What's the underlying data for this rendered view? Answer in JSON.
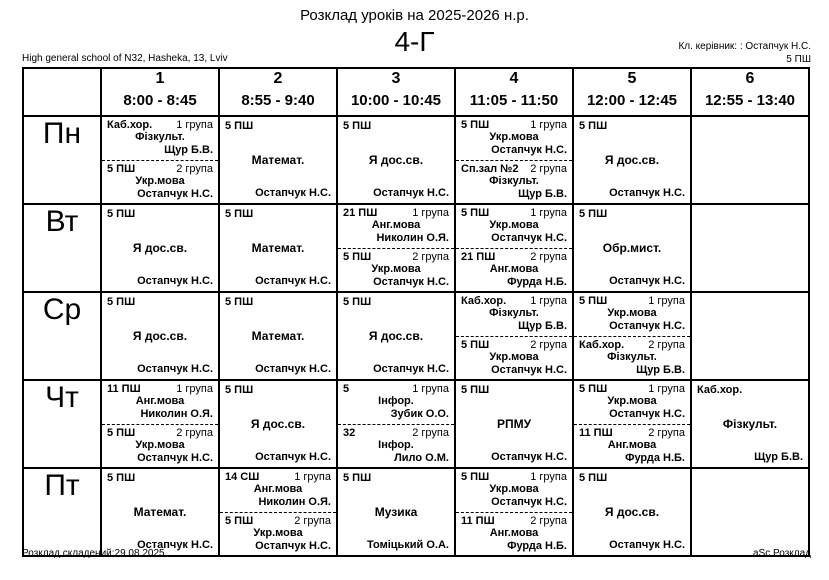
{
  "header": {
    "title": "Розклад уроків на 2025-2026 н.р.",
    "class_name": "4-Г",
    "school": "High general school of N32, Hasheka, 13, Lviv",
    "class_teacher_label": "Кл. керівник: : Остапчук Н.С.",
    "class_teacher_room": "5 ПШ"
  },
  "periods": [
    {
      "num": "1",
      "time": "8:00 - 8:45"
    },
    {
      "num": "2",
      "time": "8:55 - 9:40"
    },
    {
      "num": "3",
      "time": "10:00 - 10:45"
    },
    {
      "num": "4",
      "time": "11:05 - 11:50"
    },
    {
      "num": "5",
      "time": "12:00 - 12:45"
    },
    {
      "num": "6",
      "time": "12:55 - 13:40"
    }
  ],
  "timetable": [
    {
      "day": "Пн",
      "slots": [
        {
          "type": "split",
          "groups": [
            {
              "room": "Каб.хор.",
              "group": "1 група",
              "subject": "Фізкульт.",
              "teacher": "Щур Б.В."
            },
            {
              "room": "5 ПШ",
              "group": "2 група",
              "subject": "Укр.мова",
              "teacher": "Остапчук Н.С."
            }
          ]
        },
        {
          "type": "single",
          "room": "5 ПШ",
          "subject": "Математ.",
          "teacher": "Остапчук Н.С."
        },
        {
          "type": "single",
          "room": "5 ПШ",
          "subject": "Я дос.св.",
          "teacher": "Остапчук Н.С."
        },
        {
          "type": "split",
          "groups": [
            {
              "room": "5 ПШ",
              "group": "1 група",
              "subject": "Укр.мова",
              "teacher": "Остапчук Н.С."
            },
            {
              "room": "Сп.зал №2",
              "group": "2 група",
              "subject": "Фізкульт.",
              "teacher": "Щур Б.В."
            }
          ]
        },
        {
          "type": "single",
          "room": "5 ПШ",
          "subject": "Я дос.св.",
          "teacher": "Остапчук Н.С."
        },
        null
      ]
    },
    {
      "day": "Вт",
      "slots": [
        {
          "type": "single",
          "room": "5 ПШ",
          "subject": "Я дос.св.",
          "teacher": "Остапчук Н.С."
        },
        {
          "type": "single",
          "room": "5 ПШ",
          "subject": "Математ.",
          "teacher": "Остапчук Н.С."
        },
        {
          "type": "split",
          "groups": [
            {
              "room": "21 ПШ",
              "group": "1 група",
              "subject": "Анг.мова",
              "teacher": "Николин О.Я."
            },
            {
              "room": "5 ПШ",
              "group": "2 група",
              "subject": "Укр.мова",
              "teacher": "Остапчук Н.С."
            }
          ]
        },
        {
          "type": "split",
          "groups": [
            {
              "room": "5 ПШ",
              "group": "1 група",
              "subject": "Укр.мова",
              "teacher": "Остапчук Н.С."
            },
            {
              "room": "21 ПШ",
              "group": "2 група",
              "subject": "Анг.мова",
              "teacher": "Фурда Н.Б."
            }
          ]
        },
        {
          "type": "single",
          "room": "5 ПШ",
          "subject": "Обр.мист.",
          "teacher": "Остапчук Н.С."
        },
        null
      ]
    },
    {
      "day": "Ср",
      "slots": [
        {
          "type": "single",
          "room": "5 ПШ",
          "subject": "Я дос.св.",
          "teacher": "Остапчук Н.С."
        },
        {
          "type": "single",
          "room": "5 ПШ",
          "subject": "Математ.",
          "teacher": "Остапчук Н.С."
        },
        {
          "type": "single",
          "room": "5 ПШ",
          "subject": "Я дос.св.",
          "teacher": "Остапчук Н.С."
        },
        {
          "type": "split",
          "groups": [
            {
              "room": "Каб.хор.",
              "group": "1 група",
              "subject": "Фізкульт.",
              "teacher": "Щур Б.В."
            },
            {
              "room": "5 ПШ",
              "group": "2 група",
              "subject": "Укр.мова",
              "teacher": "Остапчук Н.С."
            }
          ]
        },
        {
          "type": "split",
          "groups": [
            {
              "room": "5 ПШ",
              "group": "1 група",
              "subject": "Укр.мова",
              "teacher": "Остапчук Н.С."
            },
            {
              "room": "Каб.хор.",
              "group": "2 група",
              "subject": "Фізкульт.",
              "teacher": "Щур Б.В."
            }
          ]
        },
        null
      ]
    },
    {
      "day": "Чт",
      "slots": [
        {
          "type": "split",
          "groups": [
            {
              "room": "11 ПШ",
              "group": "1 група",
              "subject": "Анг.мова",
              "teacher": "Николин О.Я."
            },
            {
              "room": "5 ПШ",
              "group": "2 група",
              "subject": "Укр.мова",
              "teacher": "Остапчук Н.С."
            }
          ]
        },
        {
          "type": "single",
          "room": "5 ПШ",
          "subject": "Я дос.св.",
          "teacher": "Остапчук Н.С."
        },
        {
          "type": "split",
          "groups": [
            {
              "room": "5",
              "group": "1 група",
              "subject": "Інфор.",
              "teacher": "Зубик О.О."
            },
            {
              "room": "32",
              "group": "2 група",
              "subject": "Інфор.",
              "teacher": "Лило О.М."
            }
          ]
        },
        {
          "type": "single",
          "room": "5 ПШ",
          "subject": "РПМУ",
          "teacher": "Остапчук Н.С."
        },
        {
          "type": "split",
          "groups": [
            {
              "room": "5 ПШ",
              "group": "1 група",
              "subject": "Укр.мова",
              "teacher": "Остапчук Н.С."
            },
            {
              "room": "11 ПШ",
              "group": "2 група",
              "subject": "Анг.мова",
              "teacher": "Фурда Н.Б."
            }
          ]
        },
        {
          "type": "single",
          "room": "Каб.хор.",
          "subject": "Фізкульт.",
          "teacher": "Щур Б.В."
        }
      ]
    },
    {
      "day": "Пт",
      "slots": [
        {
          "type": "single",
          "room": "5 ПШ",
          "subject": "Математ.",
          "teacher": "Остапчук Н.С."
        },
        {
          "type": "split",
          "groups": [
            {
              "room": "14 СШ",
              "group": "1 група",
              "subject": "Анг.мова",
              "teacher": "Николин О.Я."
            },
            {
              "room": "5 ПШ",
              "group": "2 група",
              "subject": "Укр.мова",
              "teacher": "Остапчук Н.С."
            }
          ]
        },
        {
          "type": "single",
          "room": "5 ПШ",
          "subject": "Музика",
          "teacher": "Томіцький О.А."
        },
        {
          "type": "split",
          "groups": [
            {
              "room": "5 ПШ",
              "group": "1 група",
              "subject": "Укр.мова",
              "teacher": "Остапчук Н.С."
            },
            {
              "room": "11 ПШ",
              "group": "2 група",
              "subject": "Анг.мова",
              "teacher": "Фурда Н.Б."
            }
          ]
        },
        {
          "type": "single",
          "room": "5 ПШ",
          "subject": "Я дос.св.",
          "teacher": "Остапчук Н.С."
        },
        null
      ]
    }
  ],
  "footer": {
    "generated": "Розклад складений:29.08.2025",
    "app": "aSc Розклад"
  },
  "colors": {
    "text": "#000000",
    "background": "#ffffff",
    "border": "#000000"
  }
}
